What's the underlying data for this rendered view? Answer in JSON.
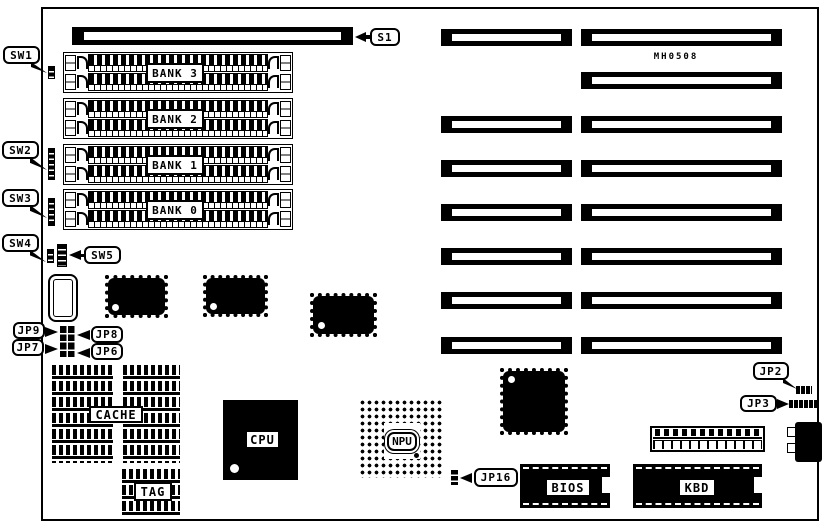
{
  "board": {
    "part_number": "MH0508",
    "colors": {
      "foreground": "#000000",
      "background": "#ffffff"
    }
  },
  "callouts": {
    "s1": "S1",
    "sw1": "SW1",
    "sw2": "SW2",
    "sw3": "SW3",
    "sw4": "SW4",
    "sw5": "SW5",
    "jp2": "JP2",
    "jp3": "JP3",
    "jp6": "JP6",
    "jp7": "JP7",
    "jp8": "JP8",
    "jp9": "JP9",
    "jp16": "JP16"
  },
  "memory_banks": {
    "bank3": "BANK 3",
    "bank2": "BANK 2",
    "bank1": "BANK 1",
    "bank0": "BANK 0"
  },
  "chips": {
    "cache": "CACHE",
    "tag": "TAG",
    "cpu": "CPU",
    "npu": "NPU",
    "bios": "BIOS",
    "kbd": "KBD"
  }
}
